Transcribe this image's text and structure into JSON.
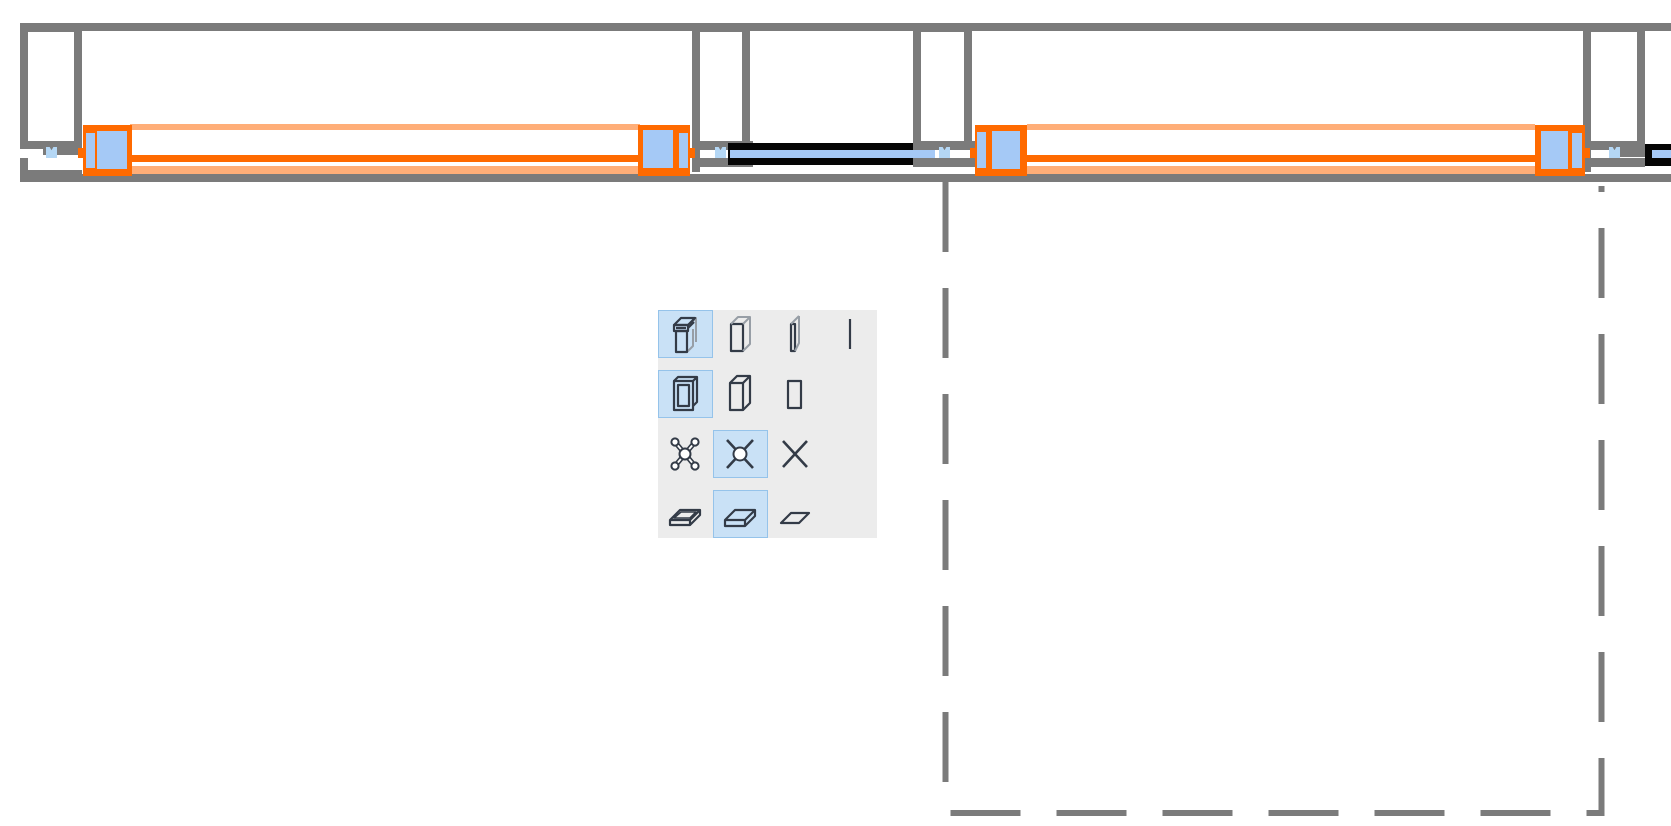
{
  "app": {
    "view": "floor-plan-detail",
    "content": "wall with selected window assemblies, sliding glass doors, columns and a dashed selection region"
  },
  "colors": {
    "wall_gray": "#7b7b7b",
    "white": "#ffffff",
    "selection_orange": "#ff6a00",
    "selection_orange_light": "#ffae78",
    "glass_blue": "#a5c9f6",
    "marker_blue": "#b4d7f5",
    "door_black": "#050505",
    "dash_gray": "#7b7b7b",
    "palette_bg": "#ececec",
    "palette_selected_bg": "#c9e1f6",
    "palette_selected_border": "#95c3ea",
    "icon_dark": "#333b47",
    "icon_gray": "#979ea6"
  },
  "drawing": {
    "rects": [
      {
        "name": "wall-top-line",
        "x": 20,
        "y": 23,
        "w": 1651,
        "h": 8,
        "c": "wall_gray",
        "i": false
      },
      {
        "name": "wall-bottom-line",
        "x": 82,
        "y": 174,
        "w": 1589,
        "h": 8,
        "c": "wall_gray",
        "i": false
      },
      {
        "name": "sill-bracket-vertical",
        "x": 20,
        "y": 158,
        "w": 8,
        "h": 24,
        "c": "wall_gray",
        "i": false
      },
      {
        "name": "sill-bracket-horizontal",
        "x": 20,
        "y": 170,
        "w": 62,
        "h": 12,
        "c": "wall_gray",
        "i": false
      },
      {
        "name": "column-a-outline",
        "x": 20,
        "y": 24,
        "w": 62,
        "h": 125,
        "c": "wall_gray",
        "i": false
      },
      {
        "name": "column-a-core",
        "x": 28,
        "y": 32,
        "w": 46,
        "h": 109,
        "c": "white",
        "i": false
      },
      {
        "name": "column-a-foot",
        "x": 43,
        "y": 145,
        "w": 39,
        "h": 10,
        "c": "wall_gray",
        "i": false
      },
      {
        "name": "column-b-outline",
        "x": 692,
        "y": 24,
        "w": 58,
        "h": 125,
        "c": "wall_gray",
        "i": false
      },
      {
        "name": "column-b-core",
        "x": 700,
        "y": 32,
        "w": 42,
        "h": 109,
        "c": "white",
        "i": false
      },
      {
        "name": "column-b-foot",
        "x": 692,
        "y": 141,
        "w": 61,
        "h": 9,
        "c": "wall_gray",
        "i": false
      },
      {
        "name": "column-b-jamb-extension",
        "x": 692,
        "y": 150,
        "w": 8,
        "h": 22,
        "c": "wall_gray",
        "i": false
      },
      {
        "name": "column-b-track-step",
        "x": 700,
        "y": 158,
        "w": 53,
        "h": 9,
        "c": "wall_gray",
        "i": false
      },
      {
        "name": "column-c-outline",
        "x": 913,
        "y": 24,
        "w": 59,
        "h": 125,
        "c": "wall_gray",
        "i": false
      },
      {
        "name": "column-c-core",
        "x": 921,
        "y": 32,
        "w": 43,
        "h": 109,
        "c": "white",
        "i": false
      },
      {
        "name": "column-c-foot",
        "x": 913,
        "y": 141,
        "w": 64,
        "h": 9,
        "c": "wall_gray",
        "i": false
      },
      {
        "name": "column-c-track-step",
        "x": 913,
        "y": 158,
        "w": 64,
        "h": 9,
        "c": "wall_gray",
        "i": false
      },
      {
        "name": "column-d-outline",
        "x": 1583,
        "y": 24,
        "w": 62,
        "h": 125,
        "c": "wall_gray",
        "i": false
      },
      {
        "name": "column-d-core",
        "x": 1591,
        "y": 32,
        "w": 46,
        "h": 109,
        "c": "white",
        "i": false
      },
      {
        "name": "column-d-foot",
        "x": 1583,
        "y": 141,
        "w": 62,
        "h": 9,
        "c": "wall_gray",
        "i": false
      },
      {
        "name": "column-d-jamb-extension",
        "x": 1583,
        "y": 150,
        "w": 8,
        "h": 22,
        "c": "wall_gray",
        "i": false
      },
      {
        "name": "column-d-track-step",
        "x": 1591,
        "y": 158,
        "w": 54,
        "h": 9,
        "c": "wall_gray",
        "i": false
      },
      {
        "name": "column-d-track-connector",
        "x": 1620,
        "y": 149,
        "w": 25,
        "h": 8,
        "c": "wall_gray",
        "i": false
      },
      {
        "name": "slidingdoor1-leaf",
        "x": 728,
        "y": 143,
        "w": 185,
        "h": 22,
        "c": "door_black",
        "i": true
      },
      {
        "name": "slidingdoor1-glass",
        "x": 730,
        "y": 150,
        "w": 205,
        "h": 8,
        "c": "glass_blue",
        "i": true
      },
      {
        "name": "slidingdoor2-leaf",
        "x": 1645,
        "y": 144,
        "w": 26,
        "h": 22,
        "c": "door_black",
        "i": true
      },
      {
        "name": "slidingdoor2-glass",
        "x": 1652,
        "y": 150,
        "w": 19,
        "h": 8,
        "c": "glass_blue",
        "i": true
      },
      {
        "name": "window1-head-line",
        "x": 130,
        "y": 124,
        "w": 510,
        "h": 6,
        "c": "selection_orange_light",
        "i": true
      },
      {
        "name": "window1-frame-line",
        "x": 130,
        "y": 155,
        "w": 510,
        "h": 7,
        "c": "selection_orange",
        "i": true
      },
      {
        "name": "window1-sill-line",
        "x": 130,
        "y": 166,
        "w": 510,
        "h": 8,
        "c": "selection_orange_light",
        "i": true
      },
      {
        "name": "window1-left-jamb",
        "x": 83,
        "y": 125,
        "w": 49,
        "h": 51,
        "c": "selection_orange",
        "i": true
      },
      {
        "name": "window1-left-jamb-glass-edge",
        "x": 86,
        "y": 133,
        "w": 9,
        "h": 35,
        "c": "glass_blue",
        "i": true
      },
      {
        "name": "window1-left-jamb-glass",
        "x": 97,
        "y": 131,
        "w": 30,
        "h": 38,
        "c": "glass_blue",
        "i": true
      },
      {
        "name": "window1-left-anchor-tab",
        "x": 78,
        "y": 148,
        "w": 5,
        "h": 10,
        "c": "selection_orange",
        "i": true
      },
      {
        "name": "window1-right-jamb",
        "x": 638,
        "y": 125,
        "w": 52,
        "h": 51,
        "c": "selection_orange",
        "i": true
      },
      {
        "name": "window1-right-jamb-glass",
        "x": 643,
        "y": 130,
        "w": 30,
        "h": 38,
        "c": "glass_blue",
        "i": true
      },
      {
        "name": "window1-right-jamb-glass-edge",
        "x": 679,
        "y": 133,
        "w": 9,
        "h": 35,
        "c": "glass_blue",
        "i": true
      },
      {
        "name": "window1-right-anchor-tab",
        "x": 690,
        "y": 148,
        "w": 5,
        "h": 10,
        "c": "selection_orange",
        "i": true
      },
      {
        "name": "window2-head-line",
        "x": 1027,
        "y": 124,
        "w": 508,
        "h": 6,
        "c": "selection_orange_light",
        "i": true
      },
      {
        "name": "window2-frame-line",
        "x": 1027,
        "y": 155,
        "w": 508,
        "h": 7,
        "c": "selection_orange",
        "i": true
      },
      {
        "name": "window2-sill-line",
        "x": 1027,
        "y": 166,
        "w": 508,
        "h": 8,
        "c": "selection_orange_light",
        "i": true
      },
      {
        "name": "window2-left-jamb",
        "x": 975,
        "y": 125,
        "w": 52,
        "h": 51,
        "c": "selection_orange",
        "i": true
      },
      {
        "name": "window2-left-jamb-glass-edge",
        "x": 977,
        "y": 132,
        "w": 9,
        "h": 36,
        "c": "glass_blue",
        "i": true
      },
      {
        "name": "window2-left-jamb-glass",
        "x": 992,
        "y": 131,
        "w": 28,
        "h": 38,
        "c": "glass_blue",
        "i": true
      },
      {
        "name": "window2-left-anchor-tab",
        "x": 970,
        "y": 148,
        "w": 5,
        "h": 10,
        "c": "selection_orange",
        "i": true
      },
      {
        "name": "window2-right-jamb",
        "x": 1535,
        "y": 125,
        "w": 50,
        "h": 51,
        "c": "selection_orange",
        "i": true
      },
      {
        "name": "window2-right-jamb-glass",
        "x": 1541,
        "y": 131,
        "w": 27,
        "h": 38,
        "c": "glass_blue",
        "i": true
      },
      {
        "name": "window2-right-jamb-glass-edge",
        "x": 1572,
        "y": 133,
        "w": 10,
        "h": 35,
        "c": "glass_blue",
        "i": true
      },
      {
        "name": "window2-right-anchor-tab",
        "x": 1585,
        "y": 148,
        "w": 5,
        "h": 10,
        "c": "selection_orange",
        "i": true
      }
    ],
    "v_markers": [
      {
        "name": "fixing-marker-1",
        "x": 46,
        "y": 147
      },
      {
        "name": "fixing-marker-2",
        "x": 715,
        "y": 147
      },
      {
        "name": "fixing-marker-3",
        "x": 939,
        "y": 147
      },
      {
        "name": "fixing-marker-4",
        "x": 1609,
        "y": 147
      }
    ],
    "dashed_region": {
      "path": "M945.5 182 L945.5 813 L1601.5 813 L1601.5 186",
      "dash": "70 36",
      "width": 6,
      "color_key": "dash_gray"
    }
  },
  "palette": {
    "name": "display-detail-level-palette",
    "x": 658,
    "y": 310,
    "width": 219,
    "height": 228,
    "cell_w": 54.75,
    "row_h": 60,
    "cell_h": 48,
    "rows": [
      {
        "group": "window-3d-display",
        "cells": [
          {
            "icon": "window-3d-detailed",
            "selected": true
          },
          {
            "icon": "window-3d-simple",
            "selected": false
          },
          {
            "icon": "window-3d-panel",
            "selected": false
          },
          {
            "icon": "window-3d-line",
            "selected": false
          }
        ]
      },
      {
        "group": "window-2d-display",
        "cells": [
          {
            "icon": "window-2d-detailed",
            "selected": true
          },
          {
            "icon": "window-2d-simple",
            "selected": false
          },
          {
            "icon": "window-2d-outline",
            "selected": false
          }
        ]
      },
      {
        "group": "column-symbol-display",
        "cells": [
          {
            "icon": "column-cross-detailed",
            "selected": false
          },
          {
            "icon": "column-cross-circle",
            "selected": true
          },
          {
            "icon": "column-cross-plain",
            "selected": false
          }
        ]
      },
      {
        "group": "slab-display",
        "cells": [
          {
            "icon": "slab-3d-detailed",
            "selected": false
          },
          {
            "icon": "slab-3d-simple",
            "selected": true
          },
          {
            "icon": "slab-2d-outline",
            "selected": false
          }
        ]
      }
    ]
  }
}
